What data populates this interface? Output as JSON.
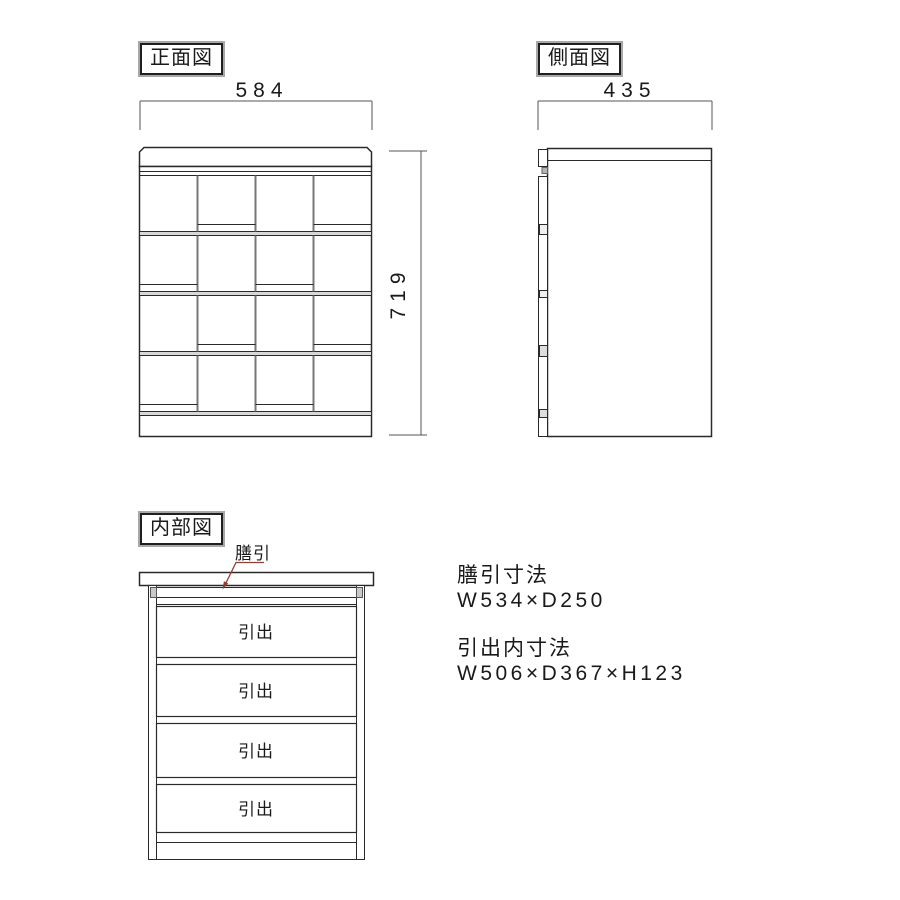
{
  "colors": {
    "line": "#2a2a2a",
    "dim_line": "#555555",
    "separator_fill": "#d8d8d8",
    "divider_gray": "#777777",
    "bracket_fill": "#c9c9c9",
    "leader": "#8f3f33",
    "background": "#ffffff"
  },
  "front_view": {
    "title": "正面図",
    "width_dim": "584",
    "height_dim": "719"
  },
  "side_view": {
    "title": "側面図",
    "width_dim": "435"
  },
  "internal_view": {
    "title": "内部図",
    "tray_label": "膳引",
    "drawers": [
      {
        "label": "引出"
      },
      {
        "label": "引出"
      },
      {
        "label": "引出"
      },
      {
        "label": "引出"
      }
    ]
  },
  "specs": {
    "tray_heading": "膳引寸法",
    "tray_dimensions": "W534×D250",
    "drawer_heading": "引出内寸法",
    "drawer_dimensions": "W506×D367×H123"
  }
}
